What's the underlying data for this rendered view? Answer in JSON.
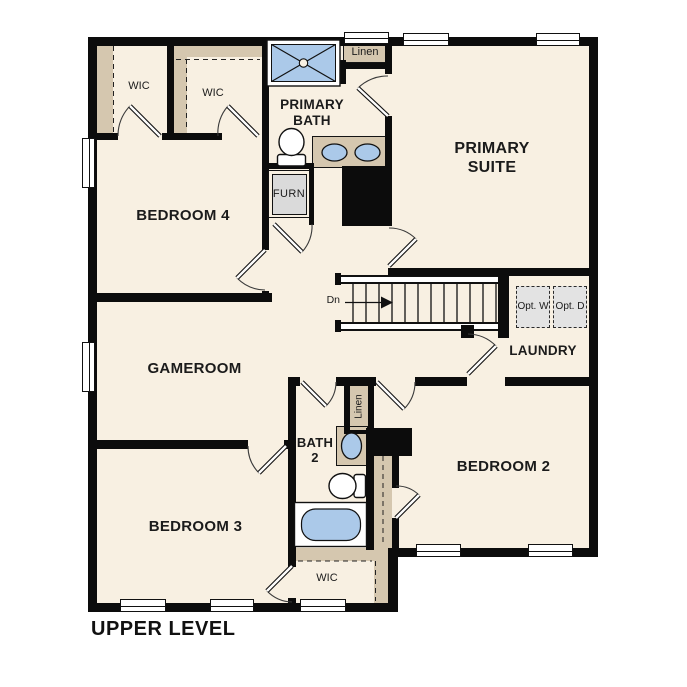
{
  "title": "UPPER LEVEL",
  "rooms": {
    "primary_suite": "PRIMARY SUITE",
    "primary_bath": "PRIMARY BATH",
    "bedroom2": "BEDROOM 2",
    "bedroom3": "BEDROOM 3",
    "bedroom4": "BEDROOM 4",
    "gameroom": "GAMEROOM",
    "laundry": "LAUNDRY",
    "bath2": "BATH 2",
    "wic_upper_left": "WIC",
    "wic_upper_mid": "WIC",
    "wic_lower": "WIC",
    "linen_top": "Linen",
    "linen_hall": "Linen",
    "furnace": "FURN"
  },
  "stairs": {
    "direction_label": "Dn"
  },
  "appliances": {
    "optional_washer": "Opt. W",
    "optional_dryer": "Opt. D"
  },
  "colors": {
    "floor": "#f8f0e2",
    "casework": "#d5c7af",
    "fixture_blue": "#abc9e9",
    "wall": "#0c0c0c",
    "appliance_gray": "#e3e3e3",
    "furn_gray": "#dadada"
  }
}
